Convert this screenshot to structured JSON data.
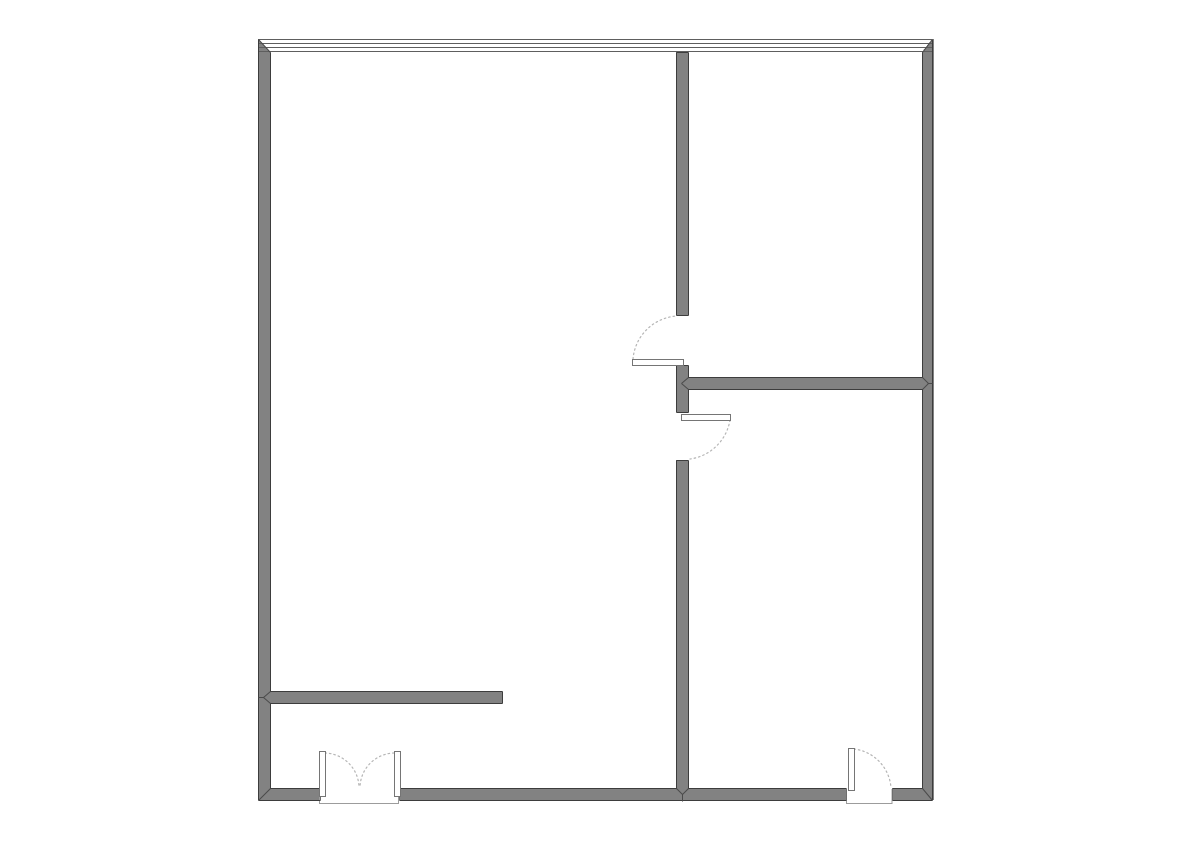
{
  "app": {
    "name": "floor-plan-drawing",
    "description": "Architectural floor plan: rectangular unit with a glazed window wall on the north side, interior partition walls dividing two rooms on the east, two interior single doors, a double entry door on the south wall and a single door on the south-east"
  },
  "canvas": {
    "width": 1191,
    "height": 842,
    "background": "#ffffff"
  },
  "palette": {
    "wall_fill": "#828282",
    "wall_outline": "#3d3d3d",
    "window_line": "#5e5e5e",
    "leaf_fill": "#ffffff",
    "leaf_outline": "#757575",
    "swing_arc": "#b5b5b5",
    "jamb_line": "#6e6e6e",
    "joint_line": "#4a4a4a",
    "threshold_outline": "#9c9c9c",
    "glazing_fill": "#ffffff"
  },
  "plan": {
    "walls": [
      {
        "name": "wall-exterior-west",
        "x": 258,
        "y": 39,
        "w": 12,
        "h": 761
      },
      {
        "name": "wall-exterior-east",
        "x": 922,
        "y": 39,
        "w": 12,
        "h": 761
      },
      {
        "name": "wall-exterior-south-west",
        "x": 258,
        "y": 788,
        "w": 62,
        "h": 12
      },
      {
        "name": "wall-exterior-south-middle",
        "x": 399,
        "y": 788,
        "w": 447,
        "h": 12
      },
      {
        "name": "wall-exterior-south-east",
        "x": 892,
        "y": 788,
        "w": 40,
        "h": 12
      },
      {
        "name": "wall-interior-vertical-upper",
        "x": 676,
        "y": 52,
        "w": 12,
        "h": 263
      },
      {
        "name": "wall-interior-vertical-middle",
        "x": 676,
        "y": 365,
        "w": 12,
        "h": 47
      },
      {
        "name": "wall-interior-vertical-lower",
        "x": 676,
        "y": 460,
        "w": 12,
        "h": 340
      },
      {
        "name": "wall-interior-horizontal-east",
        "x": 688,
        "y": 377,
        "w": 234,
        "h": 12
      },
      {
        "name": "wall-interior-stub-west",
        "x": 270,
        "y": 691,
        "w": 232,
        "h": 12
      }
    ],
    "window_band": {
      "name": "window-wall-north",
      "x": 258,
      "y": 39,
      "w": 674,
      "h": 13,
      "line_ys": [
        39.5,
        43.5,
        47.5,
        51.5
      ],
      "corner_triangles": [
        [
          258,
          39,
          258,
          52,
          270,
          52
        ],
        [
          932,
          39,
          932,
          52,
          922,
          52
        ]
      ]
    },
    "thresholds": [
      {
        "name": "threshold-entry-double-door",
        "x": 319.5,
        "y": 789,
        "w": 79,
        "h": 14.5
      },
      {
        "name": "threshold-south-east-door",
        "x": 846.5,
        "y": 789,
        "w": 45.5,
        "h": 14.5
      }
    ],
    "outlines": [
      [
        258,
        39,
        258,
        800
      ],
      [
        258,
        800,
        320,
        800
      ],
      [
        399,
        800,
        846,
        800
      ],
      [
        892,
        800,
        932,
        800
      ],
      [
        932,
        39,
        932,
        800
      ],
      [
        270,
        52,
        270,
        691
      ],
      [
        270,
        703,
        270,
        788
      ],
      [
        922,
        52,
        922,
        377
      ],
      [
        922,
        389,
        922,
        788
      ],
      [
        270,
        788,
        320,
        788
      ],
      [
        399,
        788,
        676,
        788
      ],
      [
        688,
        788,
        846,
        788
      ],
      [
        892,
        788,
        922,
        788
      ],
      [
        676,
        52,
        688,
        52
      ],
      [
        676,
        52,
        676,
        315
      ],
      [
        676,
        365,
        676,
        412
      ],
      [
        676,
        460,
        676,
        788
      ],
      [
        688,
        52,
        688,
        315
      ],
      [
        688,
        365,
        688,
        377
      ],
      [
        688,
        389,
        688,
        412
      ],
      [
        688,
        460,
        688,
        788
      ],
      [
        676,
        315,
        688,
        315
      ],
      [
        676,
        365,
        688,
        365
      ],
      [
        676,
        412,
        688,
        412
      ],
      [
        676,
        460,
        688,
        460
      ],
      [
        688,
        377,
        922,
        377
      ],
      [
        688,
        389,
        922,
        389
      ],
      [
        270,
        691,
        502,
        691
      ],
      [
        270,
        703,
        502,
        703
      ],
      [
        502,
        691,
        502,
        703
      ]
    ],
    "jambs": [
      [
        320,
        788,
        320,
        800
      ],
      [
        399,
        788,
        399,
        800
      ],
      [
        846,
        788,
        846,
        800
      ],
      [
        892,
        788,
        892,
        800
      ]
    ],
    "joints": [
      [
        258,
        39,
        270,
        52
      ],
      [
        932,
        39,
        922,
        52
      ],
      [
        270,
        788,
        258,
        800
      ],
      [
        922,
        788,
        932,
        800
      ],
      [
        270,
        691,
        263,
        697
      ],
      [
        270,
        703,
        263,
        697
      ],
      [
        258,
        697,
        263,
        697
      ],
      [
        676,
        788,
        682,
        794
      ],
      [
        688,
        788,
        682,
        794
      ],
      [
        682,
        794,
        682,
        801
      ],
      [
        922,
        377,
        928,
        383
      ],
      [
        922,
        389,
        928,
        383
      ],
      [
        928,
        383,
        932,
        383
      ],
      [
        688,
        377,
        681,
        383
      ],
      [
        688,
        389,
        681,
        383
      ]
    ],
    "doors": [
      {
        "name": "door-interior-upper",
        "leaf": {
          "x": 632,
          "y": 359,
          "w": 51,
          "h": 6
        },
        "swing": "M 633 359 A 47 47 0 0 1 677 316"
      },
      {
        "name": "door-interior-lower",
        "leaf": {
          "x": 681,
          "y": 414,
          "w": 49,
          "h": 6
        },
        "swing": "M 730 420 A 47 47 0 0 1 690 459"
      },
      {
        "name": "door-entry-double-left-leaf",
        "leaf": {
          "x": 319,
          "y": 751,
          "w": 6,
          "h": 45
        },
        "swing": "M 325 753 A 35 35 0 0 1 359 787"
      },
      {
        "name": "door-entry-double-right-leaf",
        "leaf": {
          "x": 394,
          "y": 751,
          "w": 6,
          "h": 45
        },
        "swing": "M 394 753 A 35 35 0 0 0 360 787"
      },
      {
        "name": "door-south-east",
        "leaf": {
          "x": 848,
          "y": 748,
          "w": 6,
          "h": 42
        },
        "swing": "M 854 749 A 42 42 0 0 1 891 788"
      }
    ]
  }
}
